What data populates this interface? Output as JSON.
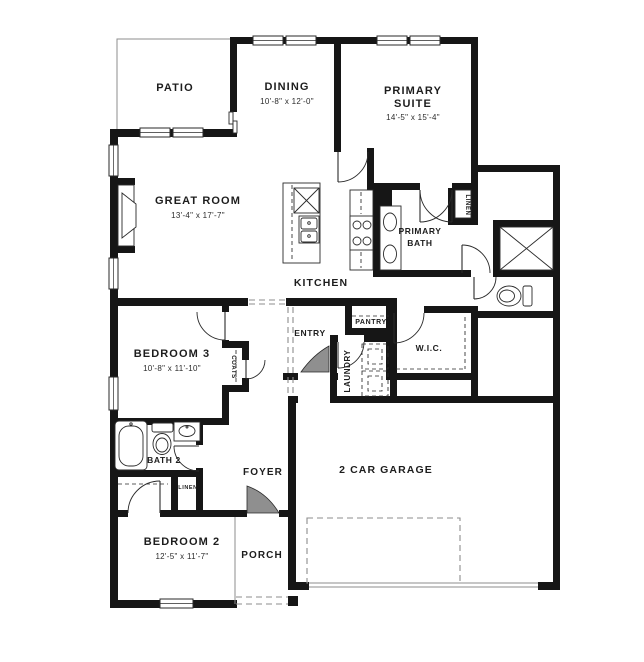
{
  "plan": {
    "rooms": {
      "patio": {
        "label": "PATIO"
      },
      "dining": {
        "label": "DINING",
        "dims": "10'-8\" x 12'-0\""
      },
      "primary_suite": {
        "lines": [
          "PRIMARY",
          "SUITE"
        ],
        "dims": "14'-5\" x 15'-4\""
      },
      "great_room": {
        "label": "GREAT ROOM",
        "dims": "13'-4\" x 17'-7\""
      },
      "kitchen": {
        "label": "KITCHEN"
      },
      "primary_bath": {
        "lines": [
          "PRIMARY",
          "BATH"
        ]
      },
      "linen_primary": {
        "label": "LINEN"
      },
      "pantry": {
        "label": "PANTRY"
      },
      "entry": {
        "label": "ENTRY"
      },
      "laundry": {
        "label": "LAUNDRY"
      },
      "wic": {
        "label": "W.I.C."
      },
      "bedroom3": {
        "label": "BEDROOM 3",
        "dims": "10'-8\" x 11'-10\""
      },
      "coats": {
        "label": "COATS"
      },
      "bath2": {
        "label": "BATH 2"
      },
      "linen_hall": {
        "label": "LINEN"
      },
      "foyer": {
        "label": "FOYER"
      },
      "bedroom2": {
        "label": "BEDROOM 2",
        "dims": "12'-5\" x 11'-7\""
      },
      "porch": {
        "label": "PORCH"
      },
      "garage": {
        "label": "2 CAR GARAGE"
      }
    },
    "colors": {
      "wall": "#161616",
      "line": "#2a2a2a",
      "thin": "#8c8c8c",
      "bg": "#ffffff",
      "door_fill": "#8f8f8f"
    }
  }
}
